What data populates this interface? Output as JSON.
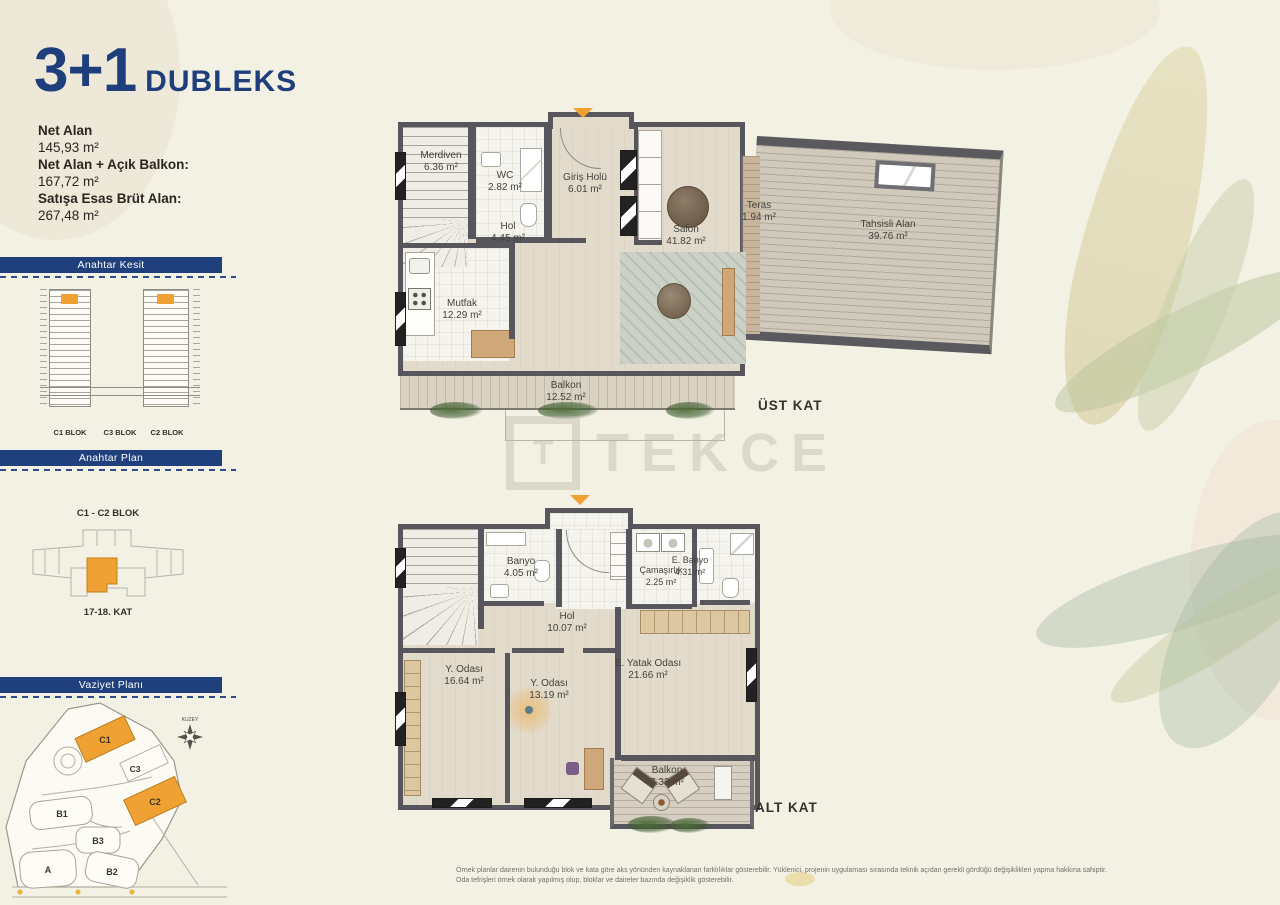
{
  "title": {
    "big": "3+1",
    "small": "DUBLEKS"
  },
  "area_info": [
    {
      "label": "Net Alan",
      "value": "145,93 m²"
    },
    {
      "label": "Net Alan + Açık Balkon:",
      "value": "167,72 m²"
    },
    {
      "label": "Satışa Esas Brüt Alan:",
      "value": "267,48 m²"
    }
  ],
  "key_section": {
    "header": "Anahtar Kesit",
    "block_labels": [
      "C1 BLOK",
      "C3 BLOK",
      "C2 BLOK"
    ]
  },
  "key_plan": {
    "header": "Anahtar Plan",
    "block_label": "C1 - C2 BLOK",
    "floor_label": "17-18. KAT"
  },
  "site_plan": {
    "header": "Vaziyet Planı",
    "north_label": "KUZEY",
    "blocks": [
      "C1",
      "C3",
      "C2",
      "B1",
      "B3",
      "B2",
      "A"
    ]
  },
  "upper_floor": {
    "floor_label": "ÜST KAT",
    "rooms": {
      "merdiven": {
        "name": "Merdiven",
        "area": "6.36 m²"
      },
      "wc": {
        "name": "WC",
        "area": "2.82 m²"
      },
      "giris_holu": {
        "name": "Giriş Holü",
        "area": "6.01 m²"
      },
      "hol": {
        "name": "Hol",
        "area": "4.45 m²"
      },
      "mutfak": {
        "name": "Mutfak",
        "area": "12.29 m²"
      },
      "salon": {
        "name": "Salon",
        "area": "41.82 m²"
      },
      "teras": {
        "name": "Teras",
        "area": "1.94 m²"
      },
      "tahsisli": {
        "name": "Tahsisli Alan",
        "area": "39.76 m²"
      },
      "balkon": {
        "name": "Balkon",
        "area": "12.52 m²"
      }
    }
  },
  "lower_floor": {
    "floor_label": "ALT KAT",
    "rooms": {
      "banyo": {
        "name": "Banyo",
        "area": "4.05 m²"
      },
      "camasirlik": {
        "name": "Çamaşırlık",
        "area": "2.25 m²"
      },
      "ebanyo": {
        "name": "E. Banyo",
        "area": "4.31 m²"
      },
      "hol": {
        "name": "Hol",
        "area": "10.07 m²"
      },
      "yodasi1": {
        "name": "Y. Odası",
        "area": "16.64 m²"
      },
      "yodasi2": {
        "name": "Y. Odası",
        "area": "13.19 m²"
      },
      "eyatak": {
        "name": "E. Yatak Odası",
        "area": "21.66 m²"
      },
      "balkon": {
        "name": "Balkon",
        "area": "7.33 m²"
      }
    }
  },
  "watermark": {
    "logo": "T",
    "text": "TEKCE"
  },
  "disclaimer": {
    "line1": "Örnek planlar dairenin bulunduğu blok ve kata göre aks yönünden kaynaklanan farklılıklar gösterebilir. Yüklenici, projenin uygulaması sırasında teknik açıdan gerekli gördüğü değişiklikleri yapma hakkına sahiptir.",
    "line2": "Oda tefrişleri örnek olarak yapılmış olup, bloklar ve daireler bazında değişiklik gösterebilir."
  },
  "colors": {
    "navy": "#20407d",
    "orange": "#efa233",
    "wall_gray": "#56565c",
    "wood_floor": "#e2dacb",
    "deck": "#d0c9bc",
    "background": "#f3f1e4"
  }
}
